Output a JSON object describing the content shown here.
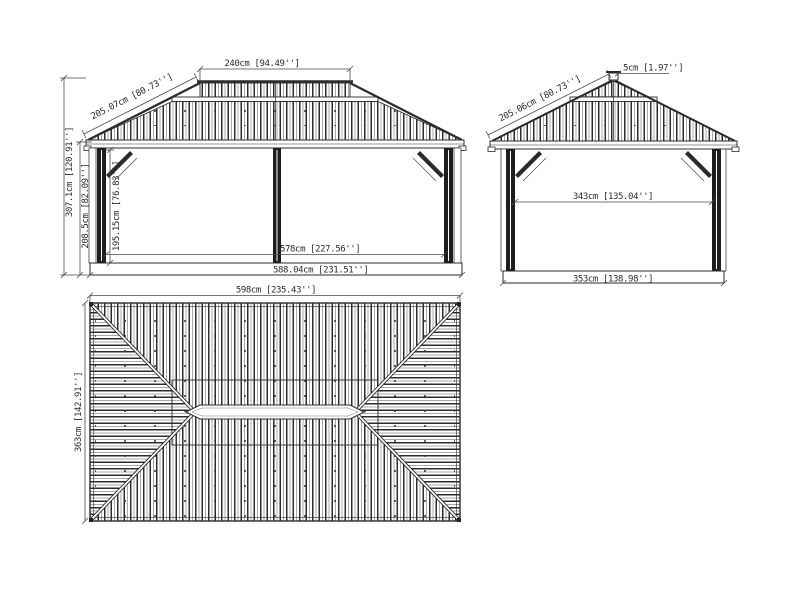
{
  "drawing": {
    "background": "#ffffff",
    "line_color": "#2b2b2b",
    "rib_dark": "#2d2d2d",
    "rib_light": "#a8a8a8",
    "views": {
      "front": {
        "dims": {
          "top_tier_width": "240cm [94.49'']",
          "roof_slope": "205.07cm [80.73'']",
          "total_height": "307.1cm [120.91'']",
          "eave_height": "208.5cm [82.09'']",
          "clear_height": "195.15cm [76.83'']",
          "post_span": "578cm [227.56'']",
          "base_width": "588.04cm [231.51'']"
        }
      },
      "side": {
        "dims": {
          "finial_height": "5cm [1.97'']",
          "roof_slope": "205.06cm [80.73'']",
          "post_span": "343cm [135.04'']",
          "base_depth": "353cm [138.98'']"
        }
      },
      "plan": {
        "dims": {
          "roof_width": "598cm [235.43'']",
          "roof_depth": "363cm [142.91'']"
        }
      }
    }
  }
}
